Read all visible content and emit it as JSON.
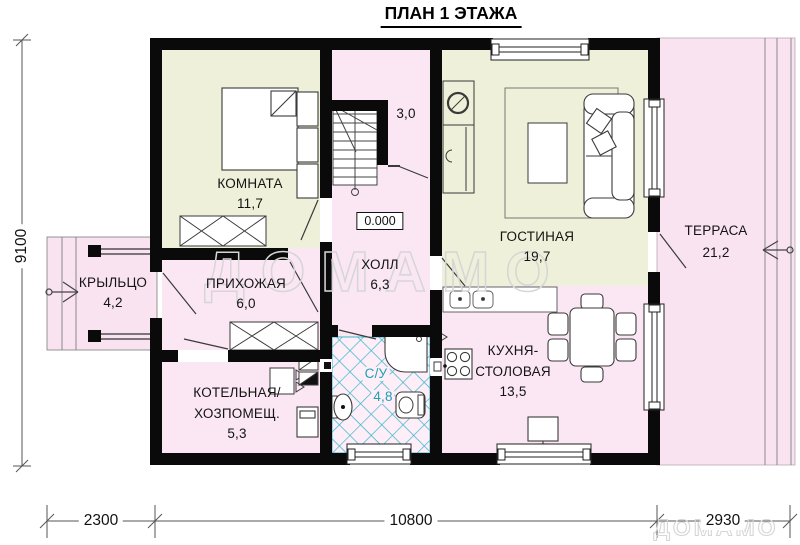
{
  "title": "ПЛАН 1 ЭТАЖА",
  "level_mark": "0.000",
  "watermark": {
    "center": "ДОМАМО",
    "corner": "ДОМАМО"
  },
  "rooms": {
    "komnata": {
      "name": "КОМНАТА",
      "area": "11,7"
    },
    "closet": {
      "area": "3,0"
    },
    "hall": {
      "name": "ХОЛЛ",
      "area": "6,3"
    },
    "gostinaya": {
      "name": "ГОСТИНАЯ",
      "area": "19,7"
    },
    "terrace": {
      "name": "ТЕРРАСА",
      "area": "21,2"
    },
    "porch": {
      "name": "КРЫЛЬЦО",
      "area": "4,2"
    },
    "prihozhaya": {
      "name": "ПРИХОЖАЯ",
      "area": "6,0"
    },
    "kotelnaya": {
      "name_line1": "КОТЕЛЬНАЯ/",
      "name_line2": "ХОЗПОМЕЩ.",
      "area": "5,3"
    },
    "sanuzel": {
      "name": "С/У",
      "area": "4,8"
    },
    "kitchen": {
      "name_line1": "КУХНЯ-",
      "name_line2": "СТОЛОВАЯ",
      "area": "13,5"
    }
  },
  "dimensions": {
    "left": "9100",
    "bottom": [
      "2300",
      "10800",
      "2930"
    ]
  },
  "colors": {
    "wall": "#0a0a0a",
    "room_green": "#eef0d9",
    "room_pink": "#fae7f3",
    "outdoor_pink": "#f9e3f1",
    "tile_teal": "#3cb7cb",
    "su_text": "#1f9fb6",
    "watermark_gray": "#d6d6d6",
    "line_dark": "#3a3a3a"
  }
}
